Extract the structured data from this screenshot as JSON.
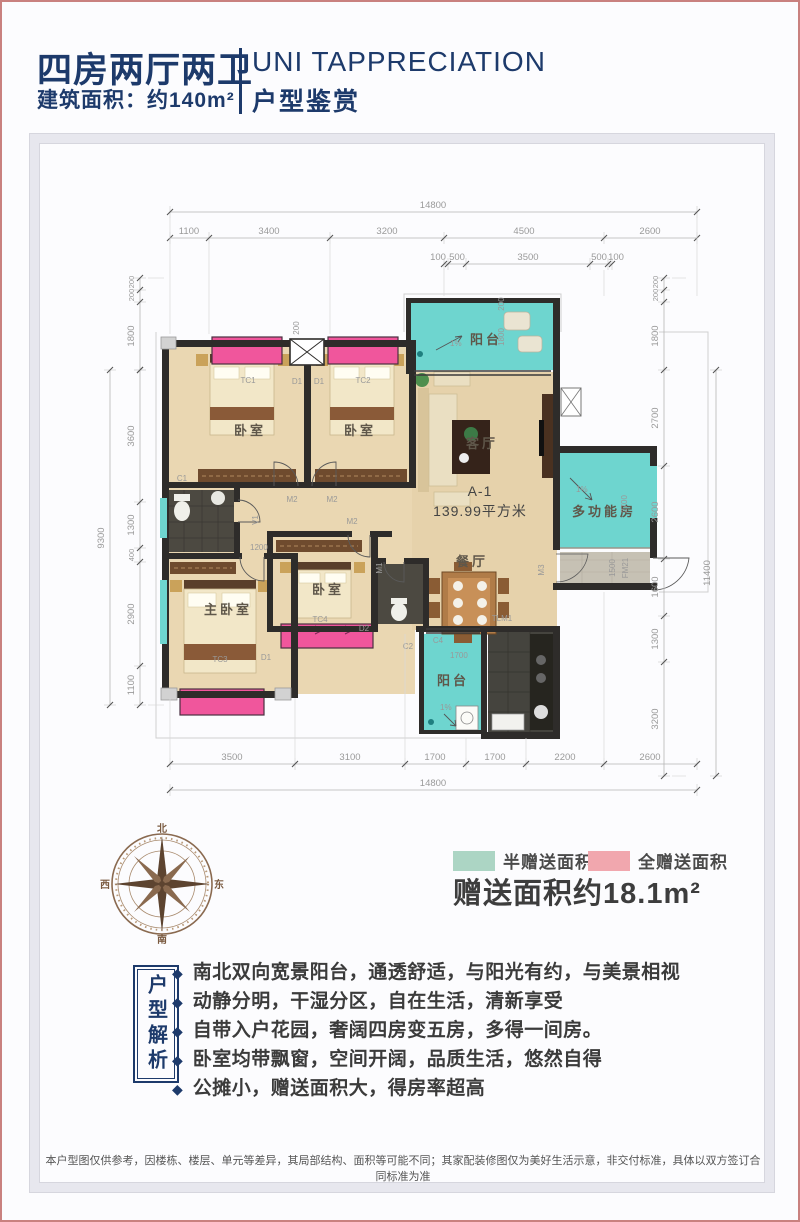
{
  "header": {
    "title": "四房两厅两卫",
    "area_line": "建筑面积：约140m²",
    "title_en": "UNI TAPPRECIATION",
    "subtitle": "户型鉴赏"
  },
  "plan": {
    "unit_label": "A-1",
    "area_label": "139.99平方米",
    "rooms": {
      "bedroom1": "卧室",
      "bedroom2": "卧室",
      "bedroom3": "卧室",
      "master": "主卧室",
      "living": "客厅",
      "dining": "餐厅",
      "balcony_top": "阳台",
      "balcony_bottom": "阳台",
      "multi_room": "多功能房"
    },
    "slope_label": "1%",
    "tags": {
      "tc1": "TC1",
      "tc2": "TC2",
      "tc3": "TC3",
      "tc4": "TC4",
      "c1": "C1",
      "c2": "C2",
      "c4": "C4",
      "d1a": "D1",
      "d1b": "D1",
      "d1c": "D1",
      "d2": "D2",
      "m1": "M1",
      "m2a": "M2",
      "m2b": "M2",
      "m2c": "M2",
      "m3": "M3",
      "v1": "V1",
      "tlm1": "TLM1",
      "fm": "FM21"
    },
    "inner_dims": {
      "balcony_top": "1800",
      "balcony_top_200": "200",
      "bay_200": "200",
      "multi": "2700",
      "foyer": "1500",
      "balcony_bottom": "1700",
      "master": "1200"
    },
    "dims": {
      "top_total": "14800",
      "top": [
        "1100",
        "3400",
        "3200",
        "4500",
        "2600"
      ],
      "top_sub": [
        "100",
        "500",
        "3500",
        "500",
        "100"
      ],
      "bottom": [
        "3500",
        "3100",
        "1700",
        "1700",
        "2200",
        "2600"
      ],
      "bottom_total": "14800",
      "left": [
        "200",
        "200",
        "1800",
        "3600",
        "1300",
        "400",
        "2900",
        "1100"
      ],
      "left_total": "9300",
      "right": [
        "200",
        "200",
        "1800",
        "2700",
        "2600",
        "1600",
        "1300",
        "3200"
      ],
      "right_total": "11400"
    }
  },
  "compass": {
    "n": "北",
    "s": "南",
    "w": "西",
    "e": "东"
  },
  "legend": {
    "half": {
      "label": "半赠送面积",
      "color": "#acd5c4"
    },
    "full": {
      "label": "全赠送面积",
      "color": "#f1a7ae"
    },
    "bonus": "赠送面积约18.1m²"
  },
  "analysis": {
    "box_label": "户型解析",
    "bullet_mark": "◆",
    "bullets": [
      "南北双向宽景阳台，通透舒适，与阳光有约，与美景相视",
      "动静分明，干湿分区，自在生活，清新享受",
      "自带入户花园，奢阔四房变五房，多得一间房。",
      "卧室均带飘窗，空间开阔，品质生活，悠然自得",
      "公摊小，赠送面积大，得房率超高"
    ]
  },
  "footer": {
    "disclaimer": "本户型图仅供参考，因楼栋、楼层、单元等差异，其局部结构、面积等可能不同；其家配装修图仅为美好生活示意，非交付标准，具体以双方签订合同标准为准"
  },
  "colors": {
    "accent_navy": "#1d3a6b",
    "page_border": "#c9817f",
    "plan_half_teal": "#6ed5cf",
    "plan_full_pink": "#f0569c",
    "legend_half": "#acd5c4",
    "legend_full": "#f1a7ae",
    "wall": "#2e2c2a",
    "wood_floor": "#ead7b2"
  }
}
